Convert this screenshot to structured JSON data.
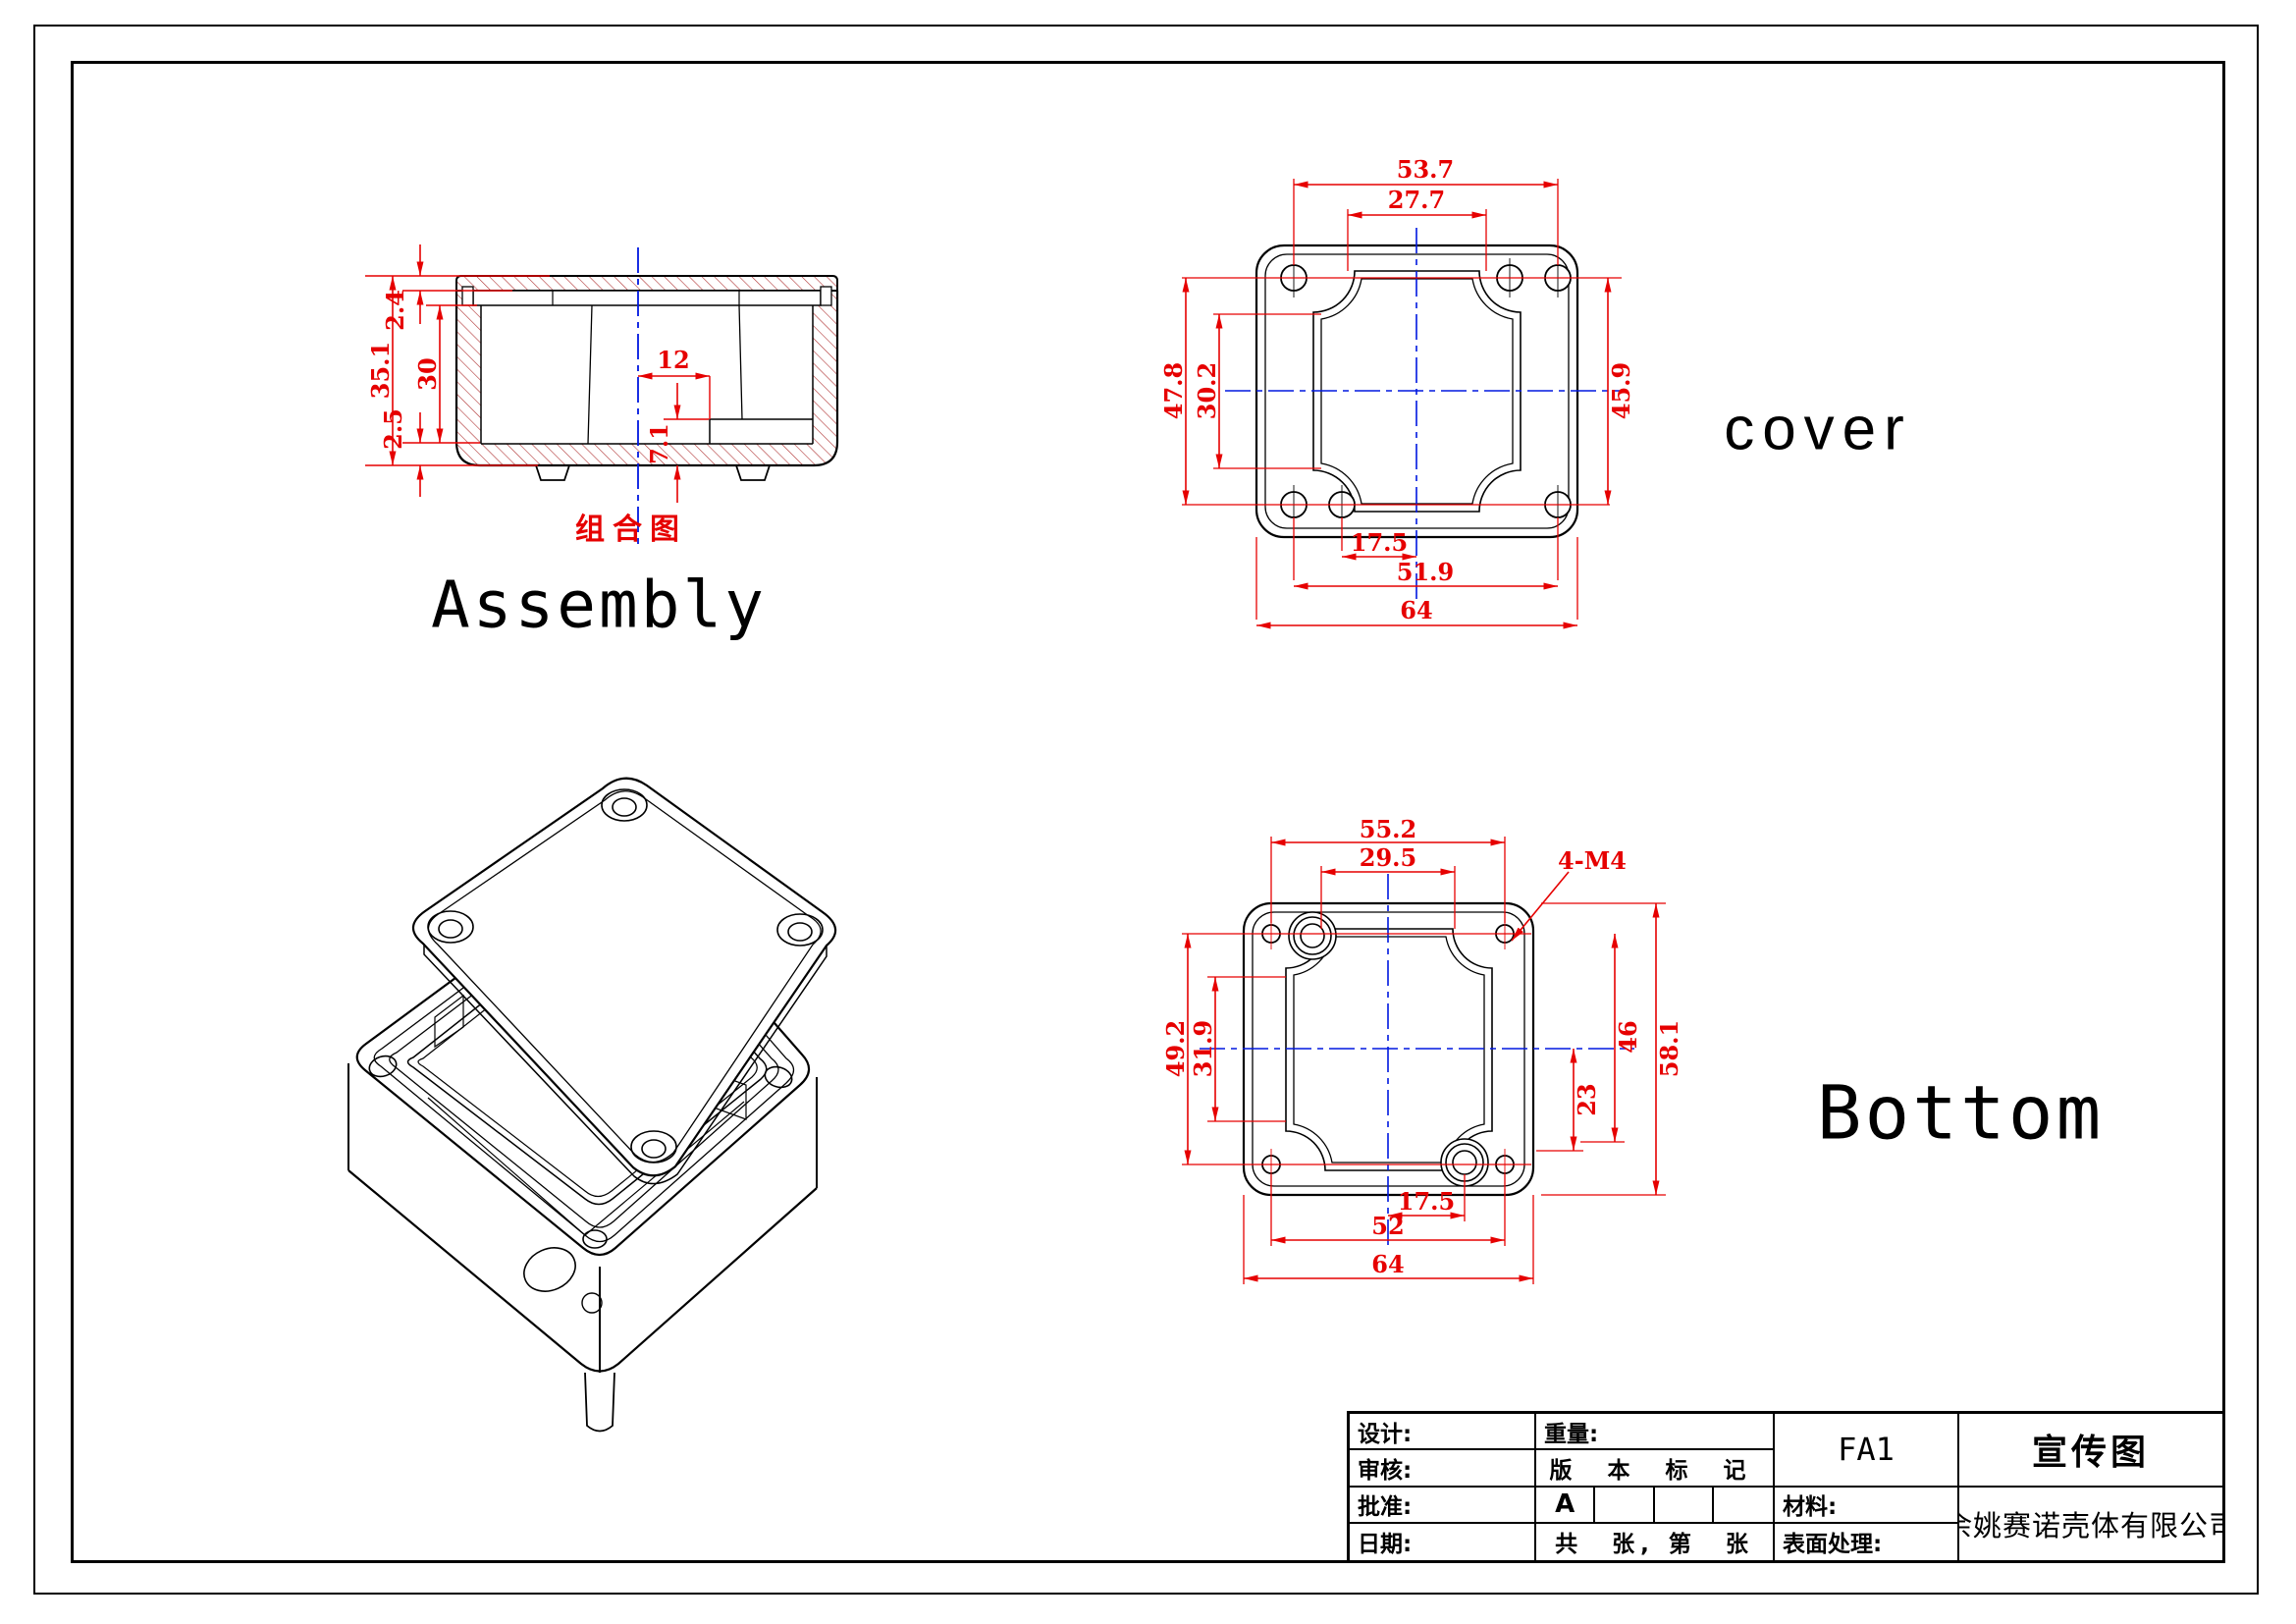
{
  "views": {
    "assembly": {
      "title_cn": "组合图",
      "title_en": "Assembly",
      "dims": {
        "overall_height": "35.1",
        "lid_thickness": "2.4",
        "cavity_depth": "30",
        "base_thickness": "2.5",
        "boss_offset": "12",
        "boss_height": "7.1"
      }
    },
    "cover": {
      "title": "cover",
      "dims": {
        "hole_span_top": "53.7",
        "window_width": "27.7",
        "hole_span_left": "47.8",
        "window_height": "30.2",
        "hole_span_right": "45.9",
        "hole_offset_bottom": "17.5",
        "hole_span_bottom": "51.9",
        "overall_width": "64"
      }
    },
    "bottom": {
      "title": "Bottom",
      "thread_callout": "4-M4",
      "dims": {
        "hole_span_top": "55.2",
        "window_width": "29.5",
        "hole_span_left": "49.2",
        "window_height": "31.9",
        "overall_height": "58.1",
        "hole_span_right": "46",
        "hole_offset_right": "23",
        "hole_offset_bottom": "17.5",
        "hole_span_bottom": "52",
        "overall_width": "64"
      }
    }
  },
  "title_block": {
    "design_label": "设计:",
    "review_label": "审核:",
    "approve_label": "批准:",
    "date_label": "日期:",
    "weight_label": "重量:",
    "version_label": "版 本 标 记",
    "revision": "A",
    "sheet_note": "共　张, 第　张",
    "part_code": "FA1",
    "material_label": "材料:",
    "surface_label": "表面处理:",
    "drawing_name": "宣传图",
    "company": "余姚赛诺壳体有限公司"
  },
  "colors": {
    "dimension_red": "#e60000",
    "centerline_blue": "#0018e0",
    "hatch_red": "#b03535",
    "line_black": "#000000"
  }
}
